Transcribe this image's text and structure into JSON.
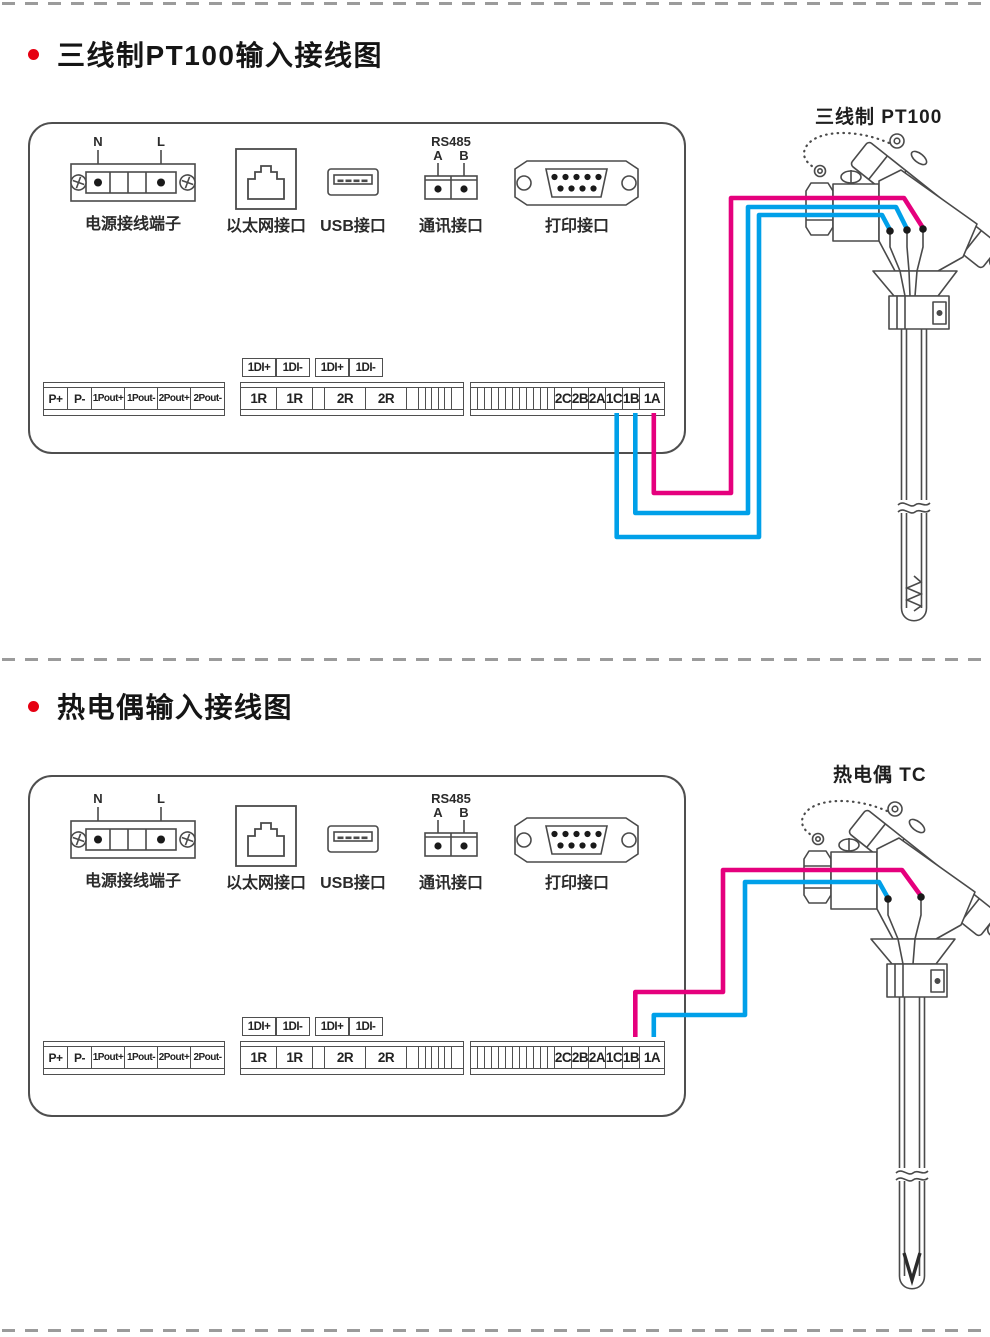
{
  "sections": {
    "s1": {
      "title": "三线制PT100输入接线图",
      "sensor_label": "三线制 PT100"
    },
    "s2": {
      "title": "热电偶输入接线图",
      "sensor_label": "热电偶 TC"
    }
  },
  "panel": {
    "power": {
      "label": "电源接线端子",
      "n": "N",
      "l": "L"
    },
    "ethernet": {
      "label": "以太网接口"
    },
    "usb": {
      "label": "USB接口"
    },
    "comm": {
      "label": "通讯接口",
      "bus": "RS485",
      "a": "A",
      "b": "B"
    },
    "printer": {
      "label": "打印接口"
    },
    "pout_cells": [
      "P+",
      "P-",
      "1Pout+",
      "1Pout-",
      "2Pout+",
      "2Pout-"
    ],
    "di_labels": [
      "1DI+",
      "1DI-",
      "1DI+",
      "1DI-"
    ],
    "relay_cells": [
      "1R",
      "1R",
      "2R",
      "2R"
    ],
    "analog_cells": [
      "2C",
      "2B",
      "2A",
      "1C",
      "1B",
      "1A"
    ]
  },
  "colors": {
    "wire_pink": "#e5007d",
    "wire_cyan": "#00a0e9",
    "line": "#4a4a4a",
    "bullet_red": "#e60012",
    "dash_gray": "#9b9b9b"
  }
}
